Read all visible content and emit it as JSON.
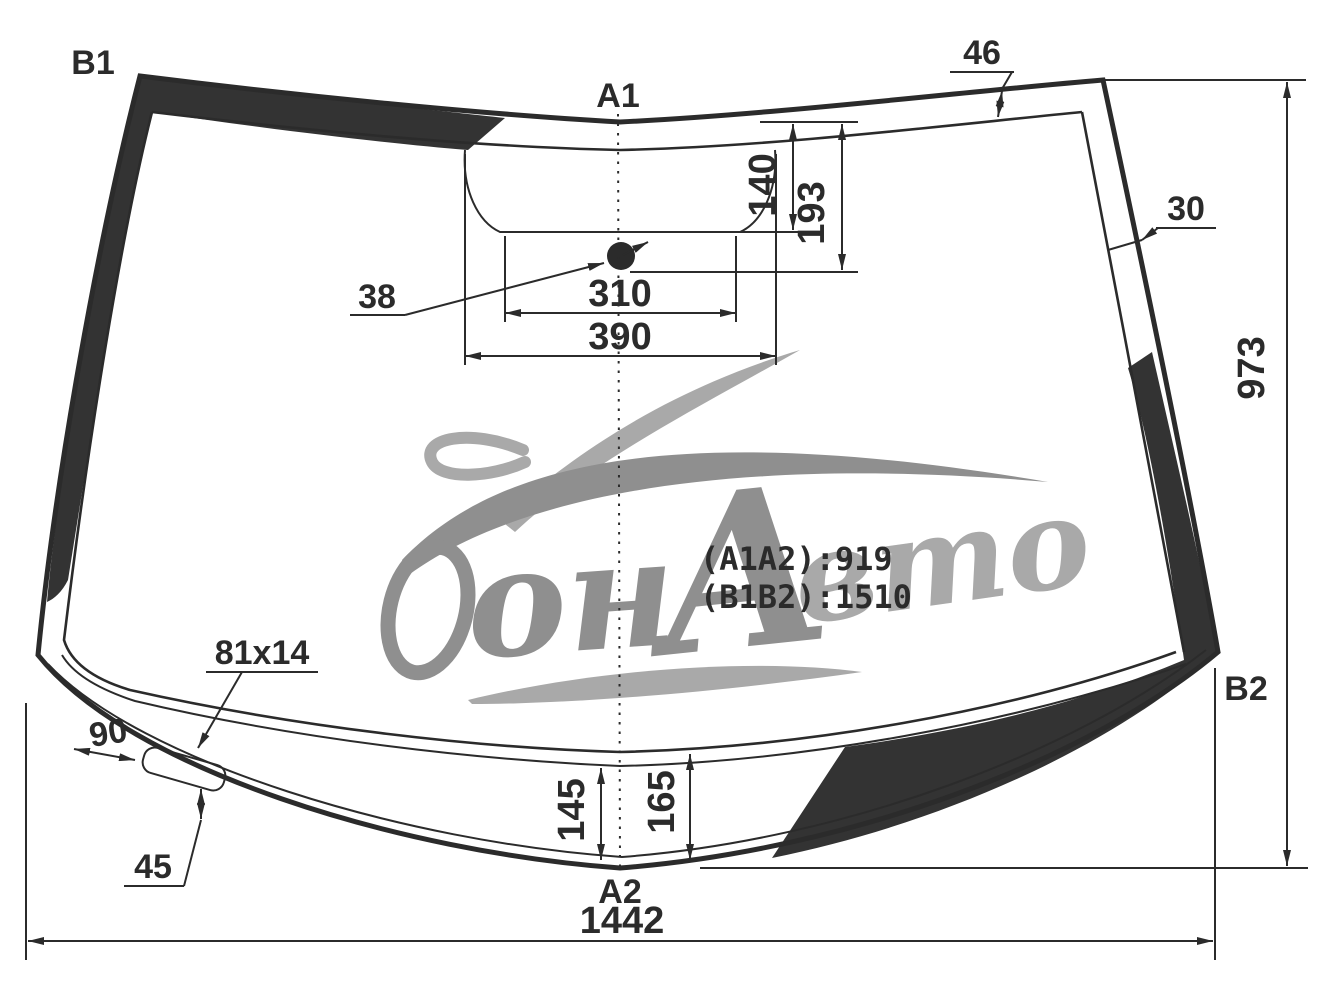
{
  "title": "Windshield glass dimensions diagram",
  "labels": {
    "b1": "B1",
    "a1": "A1",
    "a2": "A2",
    "b2": "B2"
  },
  "dims": {
    "top_band": "46",
    "side_band": "30",
    "sensor_diameter": "38",
    "sensor_width": "310",
    "window_width": "390",
    "depth_upper": "140",
    "depth_lower": "193",
    "height": "973",
    "width": "1442",
    "bracket_size": "81x14",
    "edge_offset": "90",
    "bracket_offset": "45",
    "band_center_left": "145",
    "band_center_right": "165"
  },
  "notes": {
    "a1a2": "(A1A2):919",
    "b1b2": "(B1B2):1510"
  },
  "watermark": {
    "full": "Дон Авто",
    "part_on": "он",
    "part_a": "А",
    "part_vto": "вто"
  },
  "colors": {
    "line": "#2b2b2b",
    "band_fill": "#333333",
    "watermark_dark": "#8f8f8f",
    "watermark_light": "#a9a9a9"
  }
}
